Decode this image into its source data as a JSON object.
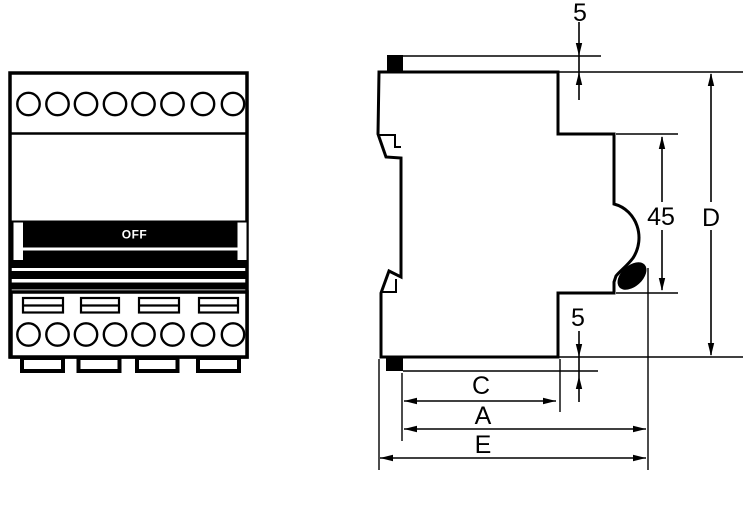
{
  "drawing_title": "modular-circuit-breaker-dimension-drawing",
  "colors": {
    "background": "#ffffff",
    "line": "#000000",
    "toggle_background": "#000000",
    "toggle_text": "#ffffff"
  },
  "front_view": {
    "toggle_label": "OFF",
    "top_terminal_count": 8,
    "bottom_terminal_count": 8,
    "label_slot_count": 4,
    "mounting_feet_count": 4
  },
  "side_view": {
    "dimensions": {
      "top_tab_height": "5",
      "front_face_height": "45",
      "overall_height": "D",
      "bottom_tab_height": "5",
      "body_depth": "C",
      "depth_with_toggle": "A",
      "overall_depth": "E"
    }
  }
}
